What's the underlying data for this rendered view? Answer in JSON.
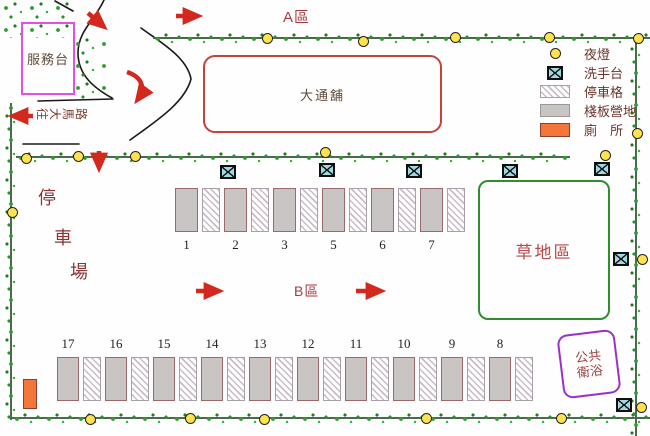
{
  "zones": {
    "a": "A區",
    "b": "B區"
  },
  "service_desk_label": "服務台",
  "bunkhouse_label": "大通舖",
  "grass_area_label": "草地區",
  "public_bath": {
    "line1": "公共",
    "line2": "衛浴"
  },
  "parking_lot_chars": [
    "停",
    "車",
    "場"
  ],
  "exit_chars": [
    "往",
    "大",
    "馬",
    "路"
  ],
  "legend": {
    "items": [
      {
        "icon": "night-light",
        "label": "夜燈"
      },
      {
        "icon": "wash-station",
        "label": "洗手台"
      },
      {
        "icon": "parking-slot",
        "label": "停車格"
      },
      {
        "icon": "pallet-campsite",
        "label": "棧板營地"
      },
      {
        "icon": "toilet",
        "label": "廁　所"
      }
    ]
  },
  "zone_b_sites": [
    "1",
    "2",
    "3",
    "5",
    "6",
    "7"
  ],
  "south_sites": [
    "17",
    "16",
    "15",
    "14",
    "13",
    "12",
    "11",
    "10",
    "9",
    "8"
  ],
  "colors": {
    "arrow_red": "#d3281e",
    "zone_label_red": "#a63a44",
    "map_text_maroon": "#8a3434",
    "legend_text": "#69352a",
    "service_border": "#e34fe3",
    "bunkhouse_border": "#c4413d",
    "grass_border": "#2f8f2f",
    "bath_border": "#9a30c9",
    "campsite_fill": "#c9c5c5",
    "toilet_fill": "#f4763a",
    "wash_station_fill": "#9fd9df",
    "night_light_fill": "#ffe34d",
    "tree_green": "#2f9e2f"
  }
}
